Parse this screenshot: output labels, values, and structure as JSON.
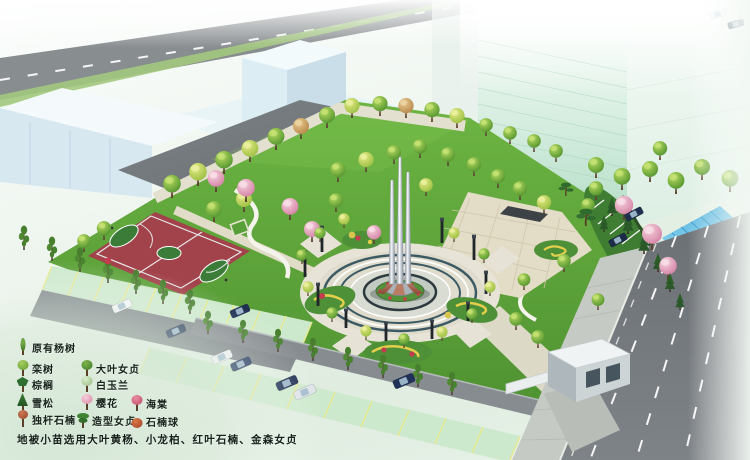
{
  "legend": {
    "items": [
      {
        "id": "existing-poplar",
        "label": "原有杨树"
      },
      {
        "id": "koelreuteria",
        "label": "栾树"
      },
      {
        "id": "big-leaf-privet",
        "label": "大叶女贞"
      },
      {
        "id": "palm",
        "label": "棕榈"
      },
      {
        "id": "white-magnolia",
        "label": "白玉兰"
      },
      {
        "id": "cedar",
        "label": "雪松"
      },
      {
        "id": "cherry-blossom",
        "label": "樱花"
      },
      {
        "id": "crabapple",
        "label": "海棠"
      },
      {
        "id": "single-trunk-photinia",
        "label": "独杆石楠"
      },
      {
        "id": "shaped-privet",
        "label": "造型女贞"
      },
      {
        "id": "photinia-ball",
        "label": "石楠球"
      }
    ],
    "note": "地被小苗选用大叶黄杨、小龙柏、红叶石楠、金森女贞"
  },
  "colors": {
    "lawn": "#5ca23a",
    "court_surface": "#a2424b",
    "court_key": "#3c7c39",
    "main_road": "#707579",
    "tower_glass": "#bfe3cf",
    "monument_steel": "#c9cfd8",
    "monument_base_bronze": "#9a5a44",
    "flower_red": "#c23b4e",
    "bed_ring_yellow": "#e3cf4c",
    "parking_stall_green": "#cde9cd",
    "stall_line_yellow": "#e9e98e",
    "bike_shed_blue": "#54b4de"
  }
}
